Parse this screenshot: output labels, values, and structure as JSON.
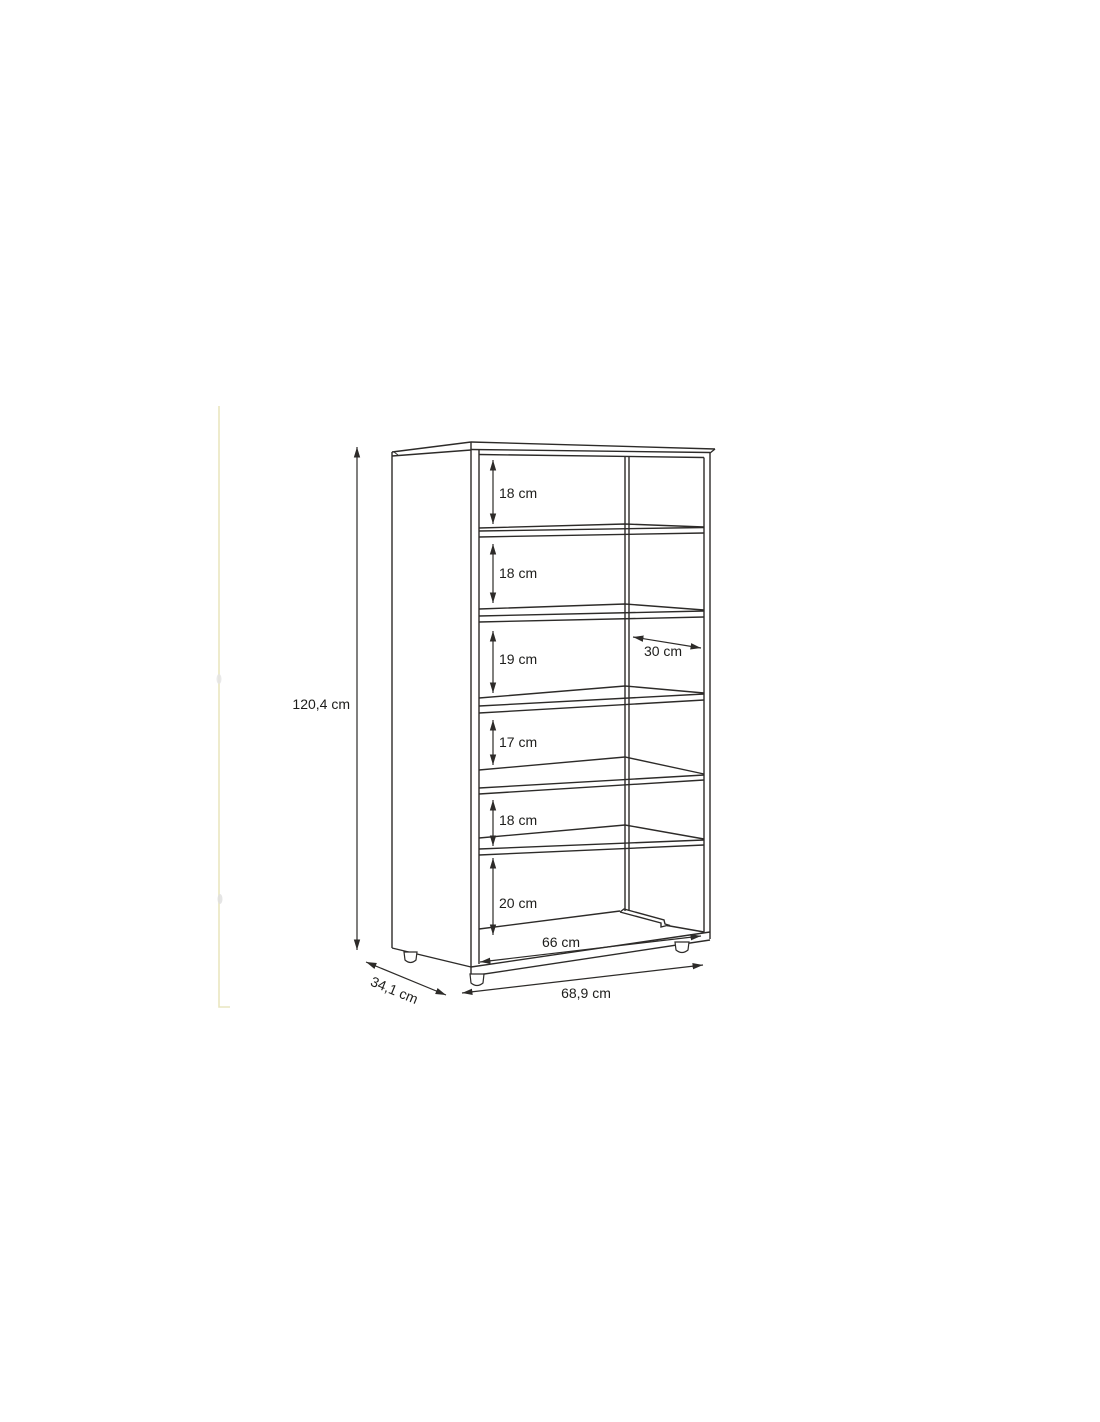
{
  "diagram": {
    "dimensions": {
      "height": "120,4 cm",
      "depth": "34,1 cm",
      "width": "68,9 cm",
      "inner_width": "66 cm",
      "shelf_depth": "30 cm",
      "compartments": [
        "18 cm",
        "18 cm",
        "19 cm",
        "17 cm",
        "18 cm",
        "20 cm"
      ]
    },
    "colors": {
      "line": "#2d2b29",
      "text": "#1d1d1b",
      "artifact_yellow": "#e9e6c0"
    }
  }
}
